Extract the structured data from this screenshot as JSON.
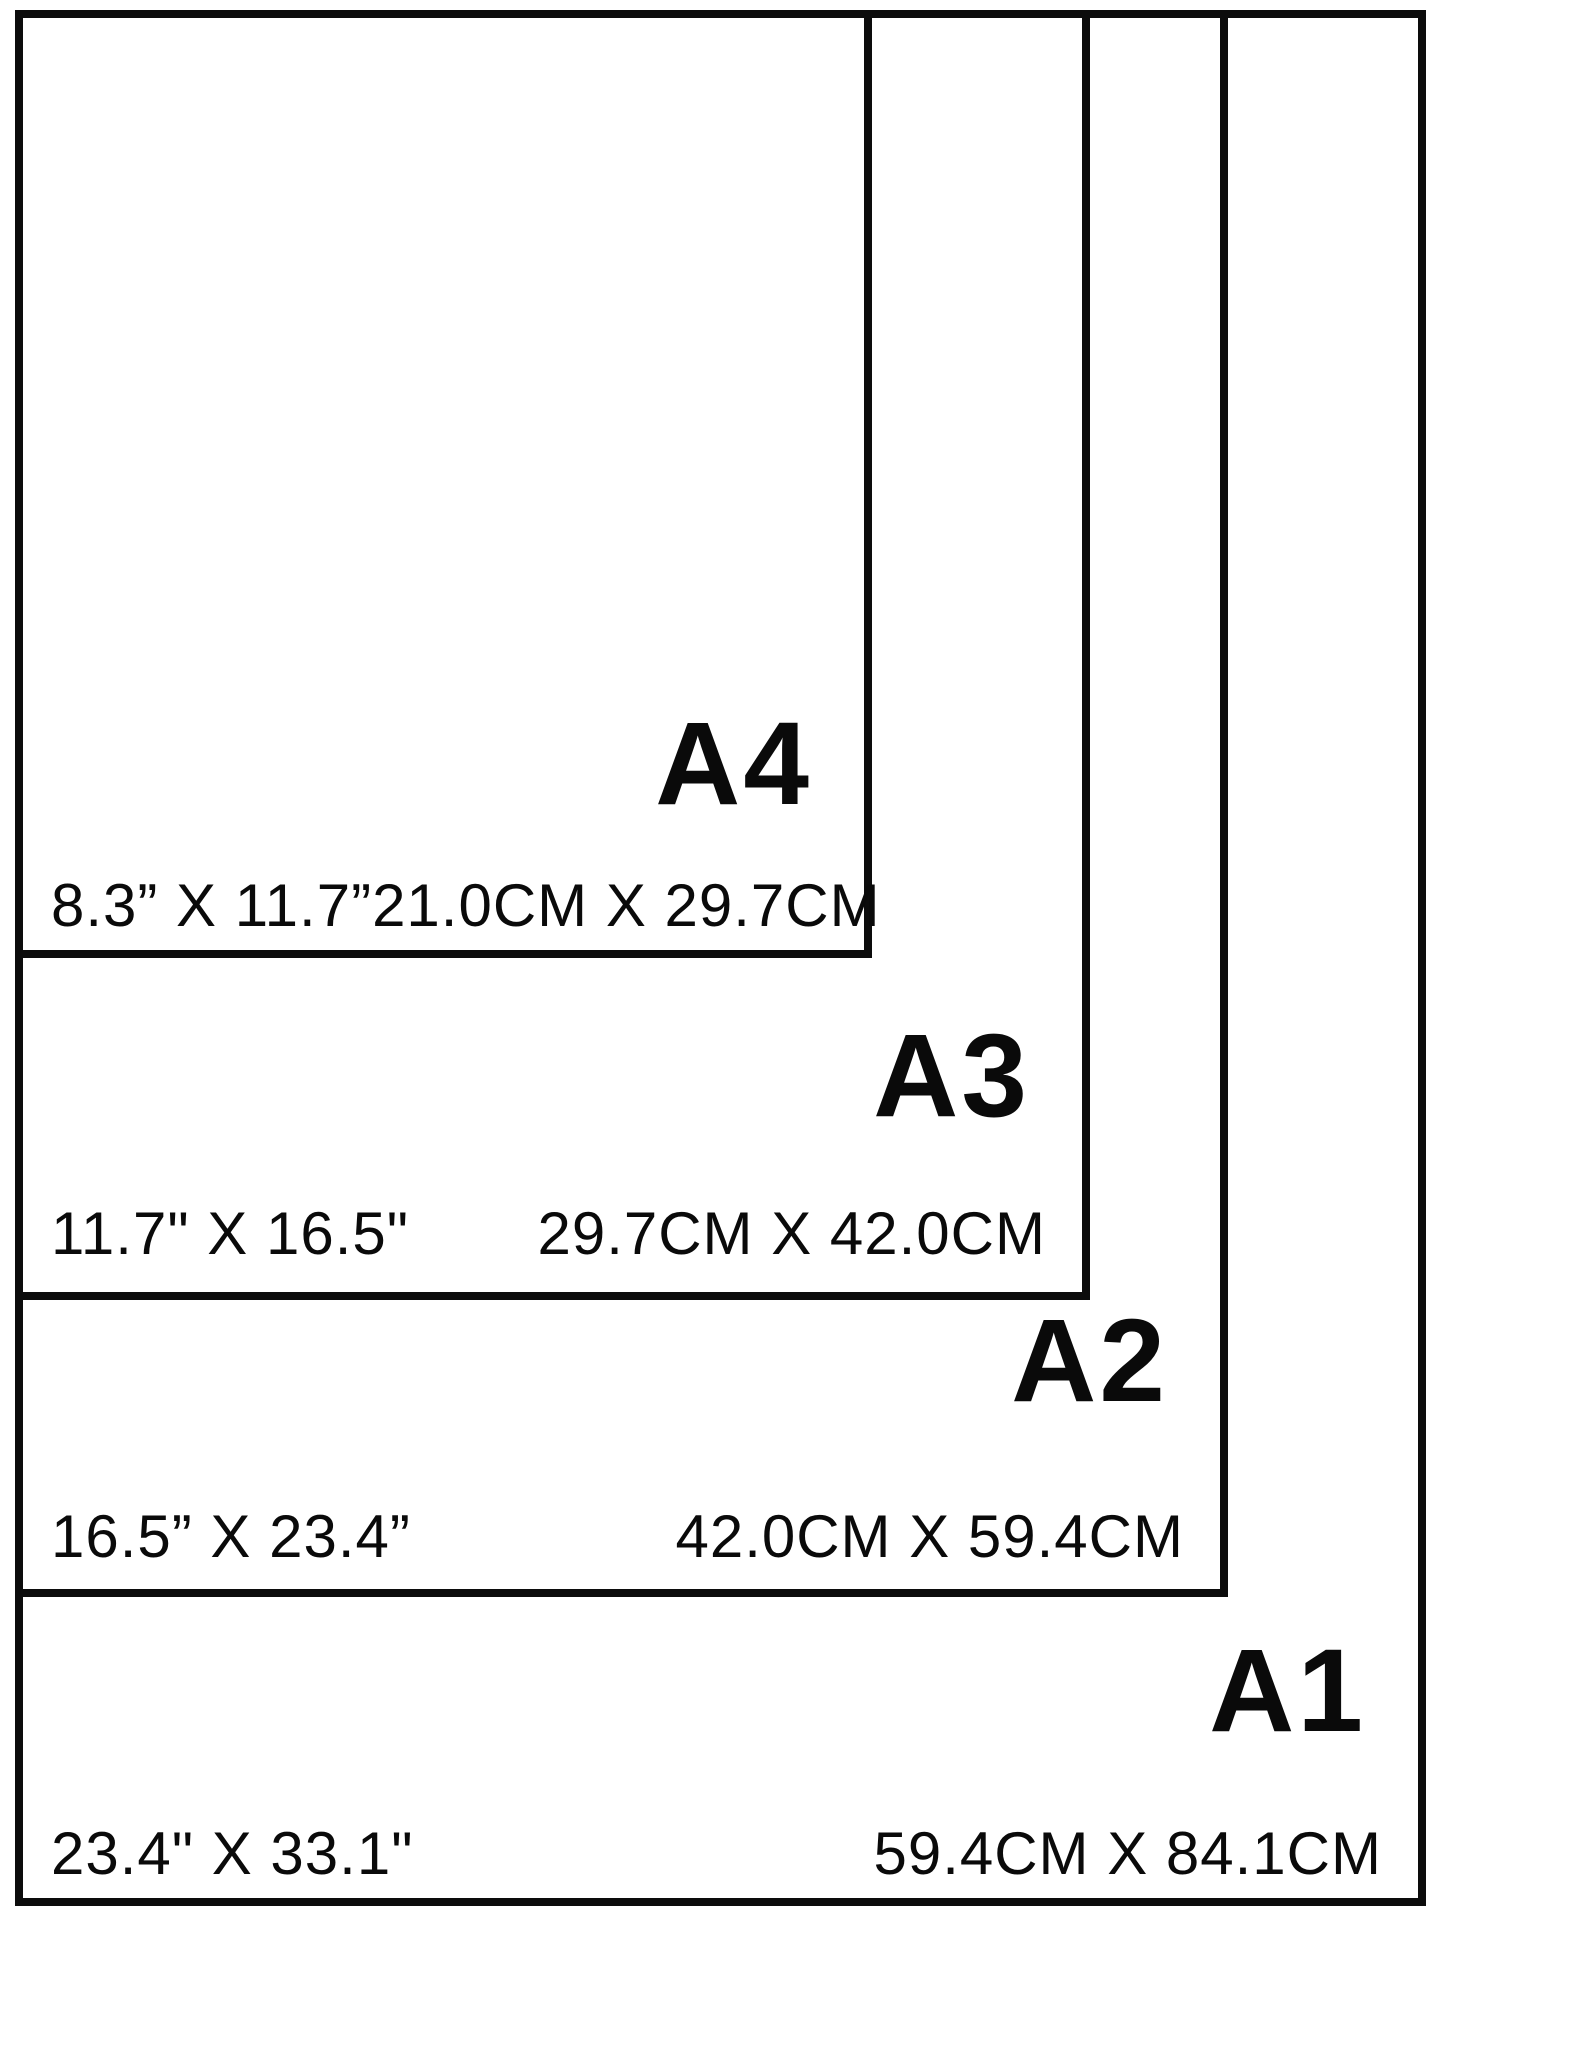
{
  "figure": {
    "description": "Nested comparison diagram of standard paper sizes",
    "colors": {
      "background": "#ffffff",
      "ink": "#0a0a0a"
    },
    "sizes": [
      {
        "name": "A4",
        "inches": "8.3” X 11.7”",
        "cm": "21.0CM X 29.7CM"
      },
      {
        "name": "A3",
        "inches": "11.7\" X 16.5\"",
        "cm": "29.7CM X 42.0CM"
      },
      {
        "name": "A2",
        "inches": "16.5” X 23.4”",
        "cm": "42.0CM X 59.4CM"
      },
      {
        "name": "A1",
        "inches": "23.4\" X 33.1\"",
        "cm": "59.4CM X 84.1CM"
      }
    ]
  }
}
